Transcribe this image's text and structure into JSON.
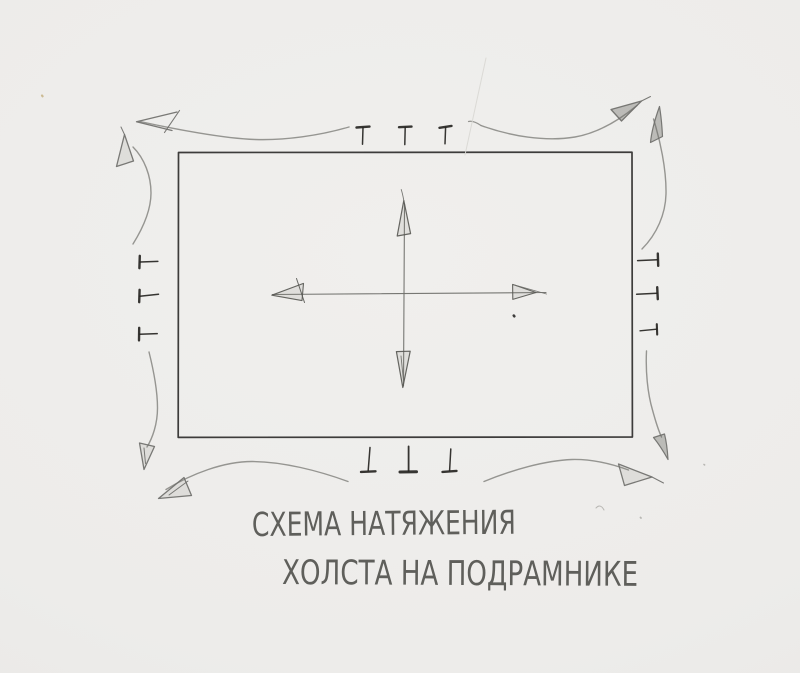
{
  "title": {
    "line1": "СХЕМА НАТЯЖЕНИЯ",
    "line2": "ХОЛСТА НА ПОДРАМНИКЕ"
  },
  "style": {
    "paper_color": "#edecea",
    "pencil_dark": "#2e2d2b",
    "pencil_medium": "#6c6c68",
    "pencil_light": "#8d8d89",
    "colors": {
      "ink_dark": "#2e2d2b",
      "tack": "#262522",
      "cross": "#6c6c68",
      "cross_head": "#595955",
      "curve": "#8d8d89",
      "curve_head": "#6f6f6b",
      "speck_gray": "#b3b2ae",
      "speck_tan": "#c9b68c",
      "scratch": "#d9d8d4"
    },
    "fills": {
      "faint": "rgba(125,125,120,0.14)",
      "mid": "rgba(105,105,100,0.38)"
    }
  },
  "diagram": {
    "canvas_rect": {
      "x": 178,
      "y": 152,
      "width": 454,
      "height": 285
    },
    "tack_count": {
      "top": 3,
      "bottom": 3,
      "left": 3,
      "right": 3
    },
    "center_arrow_directions": [
      "up",
      "down",
      "left",
      "right"
    ],
    "corner_arrow_count": 8,
    "strokes": [
      {
        "n": "canvas-outline",
        "d": "M 178.5,152.5 L 632,152.2 L 632.4,437 L 178.2,437.4 Z",
        "c": "ink_dark",
        "w": 1.7
      },
      {
        "n": "center-line-vertical",
        "d": "M 404.5,204 L 403.5,386",
        "c": "cross",
        "w": 1.1
      },
      {
        "n": "center-line-horizontal",
        "d": "M 272.5,294.5 L 546,292.5",
        "c": "cross",
        "w": 1.1
      },
      {
        "n": "center-arrow-up-head",
        "d": "M 403.8,200.5 L 397.2,236 L 410.6,233.6 Z",
        "c": "cross_head",
        "w": 1.2,
        "f": "faint"
      },
      {
        "n": "center-arrow-up-flick",
        "d": "M 403.8,200.5 C 403,196 402.4,193 401.2,189.5",
        "c": "cross",
        "w": 0.9
      },
      {
        "n": "center-arrow-down-head",
        "d": "M 402.8,387.5 L 396.4,351.6 L 410.2,351.2 Z",
        "c": "cross_head",
        "w": 1.2,
        "f": "faint"
      },
      {
        "n": "center-arrow-down-inner",
        "d": "M 403.6,382 L 401,356",
        "c": "cross",
        "w": 0.9
      },
      {
        "n": "center-arrow-left-head",
        "d": "M 271.8,295.2 L 303.5,283.4 L 302,300.6 Z",
        "c": "cross_head",
        "w": 1.1,
        "f": "faint"
      },
      {
        "n": "center-arrow-left-tick",
        "d": "M 296.5,278.5 L 304.5,302.5",
        "c": "cross_head",
        "w": 1
      },
      {
        "n": "center-arrow-right-head",
        "d": "M 536,292.5 L 512.6,284.4 L 512.8,299.4 Z",
        "c": "cross_head",
        "w": 1.1,
        "f": "faint"
      },
      {
        "n": "center-arrow-right-extension",
        "d": "M 512.6,284.4 L 546.5,294",
        "c": "cross",
        "w": 0.9
      },
      {
        "n": "center-dot",
        "d": "M 513.8,315.6 l 0.5,0.7",
        "c": "ink_dark",
        "w": 2.6
      },
      {
        "n": "tack-top-1-head",
        "d": "M 356.5,127.5 L 369.5,126.6",
        "c": "tack",
        "w": 2.4
      },
      {
        "n": "tack-top-1-shaft",
        "d": "M 363,127.5 L 362.5,144.2",
        "c": "tack",
        "w": 1.5
      },
      {
        "n": "tack-top-2-head",
        "d": "M 399,127.2 L 411.5,126.6",
        "c": "tack",
        "w": 2.4
      },
      {
        "n": "tack-top-2-shaft",
        "d": "M 405.2,127.4 L 404.8,144.6",
        "c": "tack",
        "w": 1.5
      },
      {
        "n": "tack-top-3-head",
        "d": "M 439.5,127.8 L 451.5,125.9",
        "c": "tack",
        "w": 2.4
      },
      {
        "n": "tack-top-3-shaft",
        "d": "M 445.6,127.2 L 445,143.8",
        "c": "tack",
        "w": 1.5
      },
      {
        "n": "tack-bottom-1-shaft",
        "d": "M 370,447.5 L 368.2,470.6",
        "c": "tack",
        "w": 1.5
      },
      {
        "n": "tack-bottom-1-head",
        "d": "M 361,471.9 L 375.5,471.3",
        "c": "tack",
        "w": 2.4
      },
      {
        "n": "tack-bottom-2-shaft",
        "d": "M 408.6,446.4 L 408.6,471",
        "c": "tack",
        "w": 1.8
      },
      {
        "n": "tack-bottom-2-head",
        "d": "M 400,472 L 416.5,471.8",
        "c": "tack",
        "w": 3
      },
      {
        "n": "tack-bottom-3-shaft",
        "d": "M 450.8,449 L 449.6,470.6",
        "c": "tack",
        "w": 1.5
      },
      {
        "n": "tack-bottom-3-head",
        "d": "M 442.5,471.9 L 456.5,470.9",
        "c": "tack",
        "w": 2.4
      },
      {
        "n": "tack-left-1-head",
        "d": "M 139.8,255.8 L 139.4,268.2",
        "c": "tack",
        "w": 2.4
      },
      {
        "n": "tack-left-1-shaft",
        "d": "M 140.2,262 L 157.8,261.4",
        "c": "tack",
        "w": 1.5
      },
      {
        "n": "tack-left-2-head",
        "d": "M 139.6,289.8 L 139.2,302.2",
        "c": "tack",
        "w": 2.4
      },
      {
        "n": "tack-left-2-shaft",
        "d": "M 139.8,296.2 L 158.5,294.2",
        "c": "tack",
        "w": 1.5
      },
      {
        "n": "tack-left-3-head",
        "d": "M 139.2,327.8 L 139,340.4",
        "c": "tack",
        "w": 2.4
      },
      {
        "n": "tack-left-3-shaft",
        "d": "M 139.6,334.2 L 157.2,333.6",
        "c": "tack",
        "w": 1.5
      },
      {
        "n": "tack-right-1-head",
        "d": "M 657.8,253.6 L 658.2,265.8",
        "c": "tack",
        "w": 2.4
      },
      {
        "n": "tack-right-1-shaft",
        "d": "M 657.4,259.8 L 637.6,260.6",
        "c": "tack",
        "w": 1.5
      },
      {
        "n": "tack-right-2-head",
        "d": "M 657.2,287.2 L 657.8,299.2",
        "c": "tack",
        "w": 2.4
      },
      {
        "n": "tack-right-2-shaft",
        "d": "M 657,293.2 L 636.6,294.2",
        "c": "tack",
        "w": 1.5
      },
      {
        "n": "tack-right-3-head",
        "d": "M 656.8,324.2 L 657.2,334.6",
        "c": "tack",
        "w": 2.1
      },
      {
        "n": "tack-right-3-shaft",
        "d": "M 656.6,329.2 L 640,330.8",
        "c": "tack",
        "w": 1.3
      },
      {
        "n": "curve-top-left-horizontal",
        "d": "M 349,127 C 320,135.5 285,140.5 255,139.5 C 224,138.5 174,129 140,121.5",
        "c": "curve",
        "w": 1.4
      },
      {
        "n": "arrowhead-top-left-horizontal",
        "d": "M 177,112 L 136.5,121.8 L 172,130.5",
        "c": "curve_head",
        "w": 1.3
      },
      {
        "n": "arrowhead-top-left-horizontal-extra",
        "d": "M 179.5,110.5 L 164.5,132.5",
        "c": "curve_head",
        "w": 1.1
      },
      {
        "n": "curve-top-left-vertical",
        "d": "M 133,244 C 143,228 151,210 151,193 C 151,176 144.5,158.5 133,147",
        "c": "curve",
        "w": 1.4
      },
      {
        "n": "arrowhead-top-left-vertical",
        "d": "M 124.5,134.5 L 116.5,166.5 L 133.5,161 Z",
        "c": "curve_head",
        "w": 1.3,
        "f": "faint"
      },
      {
        "n": "arrowhead-top-left-vertical-flick",
        "d": "M 124.5,134.5 L 121,127",
        "c": "curve_head",
        "w": 1
      },
      {
        "n": "curve-top-right-horizontal",
        "d": "M 481,125.5 C 510,136 545,142 575,137 C 598,133 620,119.5 637,105.5",
        "c": "curve",
        "w": 1.4
      },
      {
        "n": "curve-top-right-horizontal-tail",
        "d": "M 481,125.5 C 476.5,122.5 472.5,120.5 468.5,121.5",
        "c": "curve",
        "w": 1.2
      },
      {
        "n": "arrowhead-top-right-horizontal",
        "d": "M 641.5,101 L 611,109.5 L 621.5,121 Z",
        "c": "curve_head",
        "w": 1.3,
        "f": "mid"
      },
      {
        "n": "arrowhead-top-right-horizontal-extension",
        "d": "M 641.5,101 L 650.5,96.5",
        "c": "curve_head",
        "w": 1
      },
      {
        "n": "curve-top-right-vertical",
        "d": "M 642,249 C 657,234 665.5,214 666,194 C 666.5,169 660,140 653.5,119",
        "c": "curve",
        "w": 1.4
      },
      {
        "n": "arrowhead-top-right-vertical",
        "d": "M 659.5,106.5 C 655,119 651.5,131.5 650.5,142.5 L 662.5,136.5 C 662,126 661,115.5 659.5,106.5 Z",
        "c": "curve_head",
        "w": 1.2,
        "f": "mid"
      },
      {
        "n": "curve-bottom-left-vertical",
        "d": "M 149,352 C 154,372 157.5,392 157.5,408 C 157.5,424 152.5,438 147,447",
        "c": "curve",
        "w": 1.4
      },
      {
        "n": "arrowhead-bottom-left-vertical",
        "d": "M 144,469.5 L 139.5,443 L 154.5,446.5 Z",
        "c": "curve_head",
        "w": 1.3,
        "f": "faint"
      },
      {
        "n": "arrowhead-bottom-left-vertical-inner",
        "d": "M 145.5,463.5 L 144,448",
        "c": "curve_head",
        "w": 1
      },
      {
        "n": "curve-bottom-left-horizontal",
        "d": "M 348,481.5 C 318,470.5 282,461.5 252,461.5 C 224,461.5 192,473.5 166,489.5",
        "c": "curve",
        "w": 1.4
      },
      {
        "n": "arrowhead-bottom-left-horizontal",
        "d": "M 184,477.5 L 158.5,498.5 L 191.5,495.5 Z",
        "c": "curve_head",
        "w": 1.3,
        "f": "faint"
      },
      {
        "n": "arrowhead-bottom-left-horizontal-extra",
        "d": "M 188,481 L 169,495",
        "c": "curve_head",
        "w": 1
      },
      {
        "n": "curve-bottom-right-horizontal",
        "d": "M 484,481.5 C 512,470 545,460.5 572,459.5 C 592,459 612,464 628.5,470",
        "c": "curve",
        "w": 1.4
      },
      {
        "n": "arrowhead-bottom-right-horizontal",
        "d": "M 618.5,464 L 652,477 L 624.5,485.5 Z",
        "c": "curve_head",
        "w": 1.3,
        "f": "faint"
      },
      {
        "n": "arrowhead-bottom-right-horizontal-extension",
        "d": "M 652,477 L 663.5,483",
        "c": "curve_head",
        "w": 1
      },
      {
        "n": "curve-bottom-right-vertical",
        "d": "M 646.5,351 C 645.5,371 647.5,393 652.5,410 C 655.5,421 658,429.5 661.5,437",
        "c": "curve",
        "w": 1.4
      },
      {
        "n": "arrowhead-bottom-right-vertical",
        "d": "M 668,459.5 C 663,450.5 658,443 653.5,437.5 L 664.5,434 C 666.5,442 667.5,451 668,459.5 Z",
        "c": "curve_head",
        "w": 1.2,
        "f": "mid"
      },
      {
        "n": "paper-scratch",
        "d": "M 486,58 L 465,155",
        "c": "scratch",
        "w": 1
      },
      {
        "n": "paper-speck-tan",
        "d": "M 42,95.5 l 0.6,0.8",
        "c": "speck_tan",
        "w": 2.2
      },
      {
        "n": "paper-speck-squiggle",
        "d": "M 596,508 C 599,504.5 602,506 604,510",
        "c": "speck_gray",
        "w": 1
      },
      {
        "n": "paper-speck-dot-1",
        "d": "M 640.5,517.5 l 0.5,0.5",
        "c": "speck_gray",
        "w": 1.8
      },
      {
        "n": "paper-speck-dot-2",
        "d": "M 704,464.5 l 0.6,0.4",
        "c": "speck_gray",
        "w": 1.6
      }
    ]
  }
}
